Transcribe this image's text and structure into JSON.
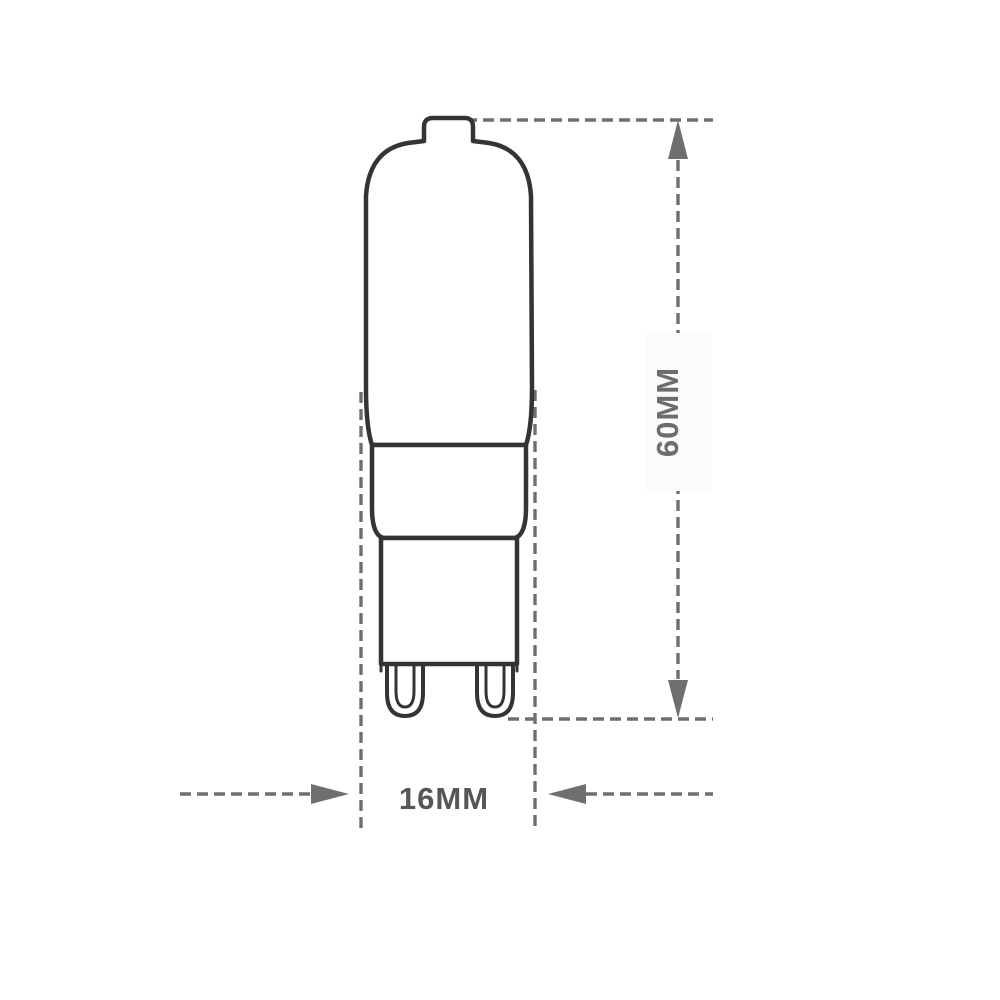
{
  "dimensions": {
    "height": {
      "label": "60MM"
    },
    "width": {
      "label": "16MM"
    }
  },
  "colors": {
    "background": "#ffffff",
    "bulb_outline": "#343434",
    "dimension_lines": "#6f6f6f",
    "height_label": "#6d6d6d",
    "width_label": "#565656"
  }
}
